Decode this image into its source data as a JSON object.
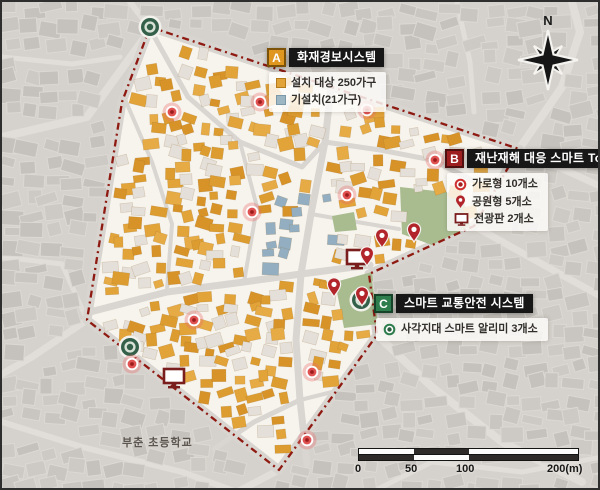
{
  "legend_a": {
    "badge": "A",
    "title": "화재경보시스템",
    "items": [
      {
        "icon": "orange-square",
        "label": "설치 대상 250가구"
      },
      {
        "icon": "blue-square",
        "label": "기설치(21가구)"
      }
    ]
  },
  "legend_b": {
    "badge": "B",
    "title": "재난재해 대응 스마트 Toolkit",
    "items": [
      {
        "icon": "red-circle-dot",
        "label": "가로형 10개소"
      },
      {
        "icon": "red-pin",
        "label": "공원형 5개소"
      },
      {
        "icon": "display-board",
        "label": "전광판 2개소"
      }
    ]
  },
  "legend_c": {
    "badge": "C",
    "title": "스마트 교통안전 시스템",
    "items": [
      {
        "icon": "green-circle-dot",
        "label": "사각지대 스마트 알리미 3개소"
      }
    ]
  },
  "compass": {
    "north_label": "N"
  },
  "scale_bar": {
    "ticks": [
      "0",
      "50",
      "100",
      "200(m)"
    ]
  },
  "map_labels": {
    "school": "부춘 초등학교"
  },
  "markers": {
    "street_type_red_circles": [
      [
        170,
        110
      ],
      [
        258,
        100
      ],
      [
        365,
        108
      ],
      [
        433,
        158
      ],
      [
        345,
        193
      ],
      [
        250,
        210
      ],
      [
        192,
        318
      ],
      [
        130,
        362
      ],
      [
        310,
        370
      ],
      [
        305,
        438
      ]
    ],
    "park_type_red_pins": [
      [
        380,
        237
      ],
      [
        412,
        231
      ],
      [
        365,
        255
      ],
      [
        360,
        295
      ],
      [
        332,
        286
      ]
    ],
    "display_board_monitors": [
      [
        355,
        257
      ],
      [
        172,
        376
      ]
    ],
    "blind_spot_green_circles": [
      [
        148,
        25
      ],
      [
        128,
        345
      ],
      [
        359,
        298
      ]
    ]
  },
  "colors": {
    "boundary": "#8e1a12",
    "inside_bg": "#f7f4ee",
    "outside_bg": "#d5d1cc",
    "building_target": "#e2a338",
    "building_installed": "#93aec0",
    "park_green": "#a9bc90",
    "marker_red": "#c22f2f",
    "marker_green": "#34604a",
    "monitor_border": "#7a1d1d"
  }
}
